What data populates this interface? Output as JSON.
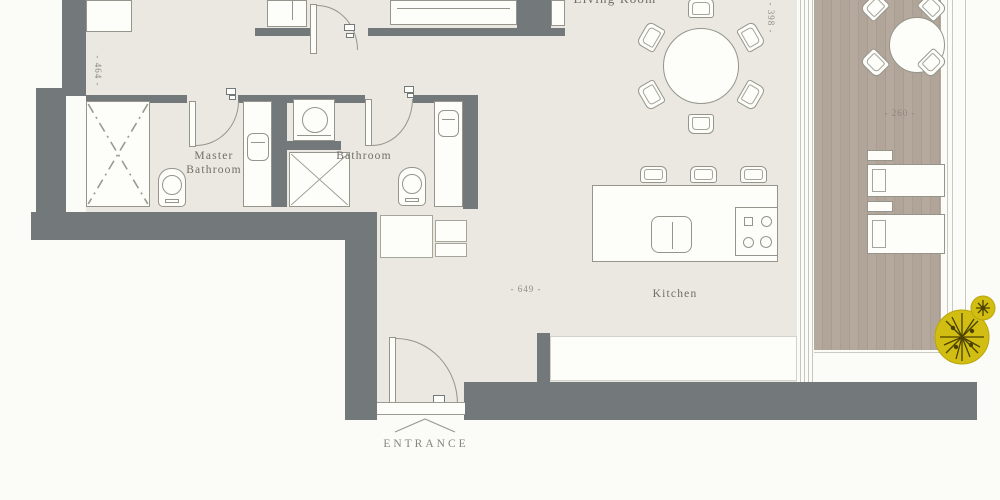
{
  "labels": {
    "living_room": "Living Room",
    "master_bathroom": "Master Bathroom",
    "bathroom": "Bathroom",
    "kitchen": "Kitchen",
    "entrance": "ENTRANCE"
  },
  "dimensions": {
    "hall_width": "- 464 -",
    "kitchen_length": "- 649 -",
    "living_width": "- 398 -",
    "balcony_width": "- 260 -"
  },
  "colors": {
    "wall": "#73797b",
    "floor": "#eae8e1",
    "wood": "#b3a79c",
    "outline": "#95958c",
    "gold_seal": "#d2be12"
  }
}
